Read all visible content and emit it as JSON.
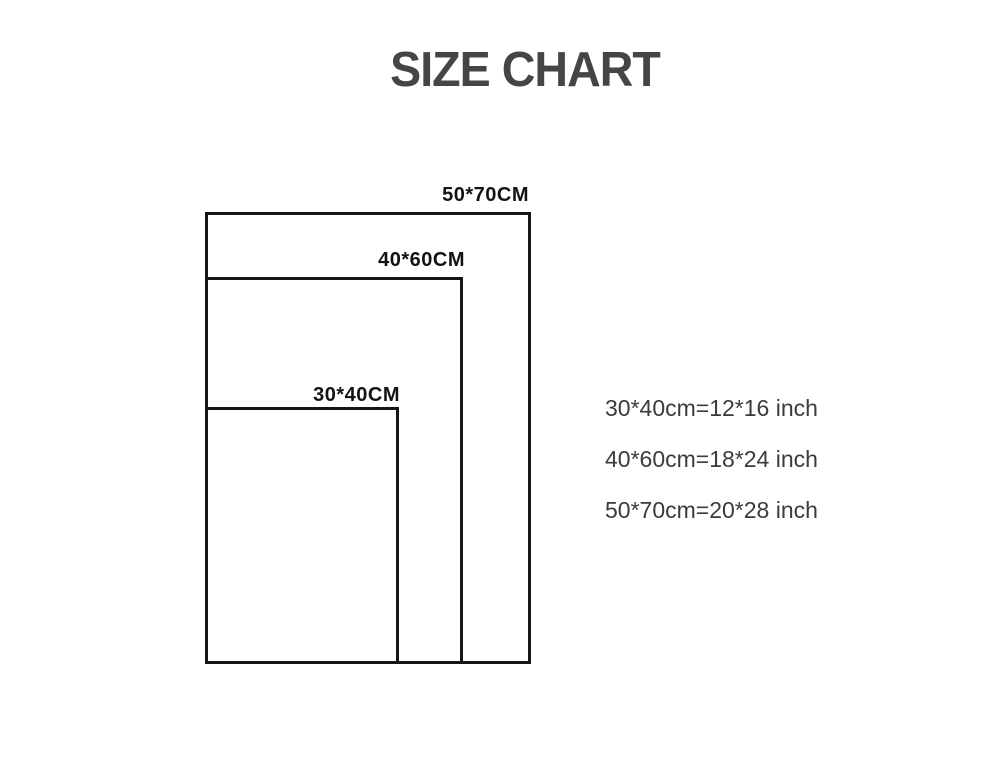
{
  "title": "SIZE CHART",
  "colors": {
    "background": "#ffffff",
    "title_text": "#454545",
    "rectangle_line": "#161616",
    "size_label_text": "#131313",
    "conversion_text": "#3b3b3b"
  },
  "rectangles": [
    {
      "id": "50x70",
      "label": "50*70CM",
      "width_cm": 50,
      "height_cm": 70
    },
    {
      "id": "40x60",
      "label": "40*60CM",
      "width_cm": 40,
      "height_cm": 60
    },
    {
      "id": "30x40",
      "label": "30*40CM",
      "width_cm": 30,
      "height_cm": 40
    }
  ],
  "conversions": [
    {
      "text": "30*40cm=12*16 inch",
      "cm": "30*40",
      "inch": "12*16"
    },
    {
      "text": "40*60cm=18*24 inch",
      "cm": "40*60",
      "inch": "18*24"
    },
    {
      "text": "50*70cm=20*28 inch",
      "cm": "50*70",
      "inch": "20*28"
    }
  ]
}
